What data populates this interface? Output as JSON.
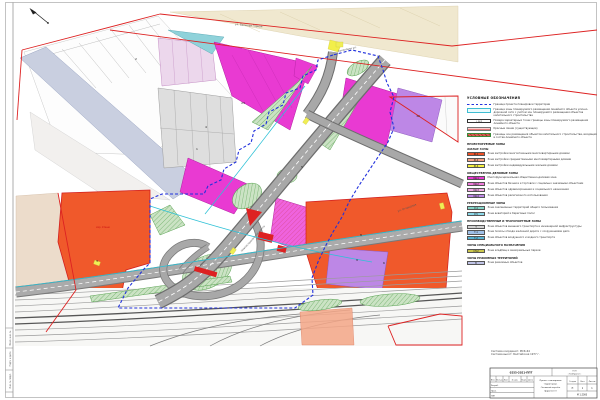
{
  "legend": {
    "title": "УСЛОВНЫЕ ОБОЗНАЧЕНИЯ",
    "symbols": [
      {
        "kind": "dash",
        "label": "Граница проекта планировки территории"
      },
      {
        "kind": "cyanbox",
        "label": "Граница зоны планируемого размещения линейного объекта улично-дорожной сети с учётом зон планируемого размещения объектов капитального строительства"
      },
      {
        "kind": "point",
        "code": "А-1",
        "label": "Номера характерных точек границы зоны планируемого размещения линейного объекта"
      },
      {
        "kind": "redline",
        "label": "Красные линии (существующие)"
      },
      {
        "kind": "redhatch",
        "label": "Границы зон размещения объектов капитального строительства, входящих в состав линейного объекта"
      }
    ],
    "groups": [
      {
        "header": "ПРОЕКТИРУЕМЫЕ ЗОНЫ",
        "subheader": "ЖИЛЫЕ ЗОНЫ",
        "items": [
          {
            "code": "Ж-1",
            "color": "#ee5026",
            "label": "Зона застройки многоэтажными многоквартирными домами"
          },
          {
            "code": "Ж-2",
            "color": "#f4a285",
            "label": "Зона застройки среднеэтажными многоквартирными домами"
          },
          {
            "code": "Ж-4",
            "color": "#f6f140",
            "label": "Зона застройки индивидуальными жилыми домами"
          }
        ]
      },
      {
        "header": "ОБЩЕСТВЕННО-ДЕЛОВЫЕ ЗОНЫ",
        "items": [
          {
            "code": "ОД-1",
            "color": "#e93ad2",
            "label": "Многофункциональная общественно-деловая зона"
          },
          {
            "code": "ОД-2",
            "color": "#f07bdb",
            "label": "Зона объектов бизнеса и торговли с социально значимыми объектами"
          },
          {
            "code": "ОД-3",
            "color": "#f3abe7",
            "label": "Зона объектов здравоохранения и социального назначения"
          },
          {
            "code": "ОД-4",
            "color": "#bd87e6",
            "label": "Зона объектов религиозного использования"
          }
        ]
      },
      {
        "header": "РЕКРЕАЦИОННЫЕ ЗОНЫ",
        "items": [
          {
            "code": "Р-4",
            "color": "#86d6c9",
            "label": "Зона озеленённых территорий общего пользования"
          },
          {
            "code": "Р-5",
            "color": "#8cd8e8",
            "label": "Зона акваторий и береговых полос"
          }
        ]
      },
      {
        "header": "ПРОИЗВОДСТВЕННЫЕ И ТРАНСПОРТНЫЕ ЗОНЫ",
        "items": [
          {
            "code": "Т",
            "color": "#d2d2d2",
            "label": "Зона объектов внешнего транспорта и инженерной инфраструктуры"
          },
          {
            "code": "Т-1",
            "color": "#9fc0e8",
            "label": "Зона полосы отвода железной дороги с сооружениями депо"
          },
          {
            "code": "Т-2",
            "color": "#58b4d4",
            "label": "Зона объектов воздушного и водного транспорта"
          }
        ]
      },
      {
        "header": "ЗОНЫ СПЕЦИАЛЬНОГО НАЗНАЧЕНИЯ",
        "items": [
          {
            "code": "СН-2",
            "color": "#cdc94e",
            "label": "Зона кладбищ и мемориальных парков"
          }
        ]
      },
      {
        "header": "ЗОНЫ РЕЖИМНЫХ ТЕРРИТОРИЙ",
        "items": [
          {
            "code": "В",
            "color": "#bfc3e6",
            "label": "Зона режимных объектов"
          }
        ]
      }
    ]
  },
  "map": {
    "street_labels": [
      {
        "text": "Соколовая ул.",
        "x": 338,
        "y": 52,
        "rot": -12
      },
      {
        "text": "ул. Большая Горная",
        "x": 235,
        "y": 25,
        "rot": 5
      },
      {
        "text": "Новоастраханское шоссе",
        "x": 242,
        "y": 252,
        "rot": -48
      },
      {
        "text": "ул. Огородная",
        "x": 398,
        "y": 212,
        "rot": -20
      }
    ],
    "zone_numbers": [
      {
        "text": "23",
        "x": 243,
        "y": 104
      },
      {
        "text": "1",
        "x": 197,
        "y": 150
      },
      {
        "text": "2",
        "x": 136,
        "y": 60
      },
      {
        "text": "4",
        "x": 206,
        "y": 128
      },
      {
        "text": "5",
        "x": 302,
        "y": 168
      },
      {
        "text": "8",
        "x": 361,
        "y": 236
      },
      {
        "text": "9",
        "x": 357,
        "y": 261
      },
      {
        "text": "12",
        "x": 418,
        "y": 117
      },
      {
        "text": "6",
        "x": 384,
        "y": 264
      },
      {
        "text": "3",
        "x": 97,
        "y": 262
      }
    ],
    "red_note": "мкр. Улеши"
  },
  "notes": [
    "Система координат: МСК-64",
    "Система высот: Балтийская 1977 г."
  ],
  "margin_labels": [
    "Взам. инв. №",
    "Подп. и дата",
    "Инв. № подл."
  ],
  "stamp": {
    "doc_number": "0255-2021-ППТ",
    "org_lines": [
      "ООО",
      "«ГеоПроект»"
    ],
    "title_lines": [
      "Проект планировки",
      "территории.",
      "Основной чертёж",
      "(фрагмент)"
    ],
    "columns": [
      "Изм.",
      "Кол.уч",
      "Лист",
      "№ док.",
      "Подп.",
      "Дата"
    ],
    "roles": [
      "Разраб.",
      "Пров.",
      "ГИП"
    ],
    "stage_label": "Стадия",
    "sheet_label": "Лист",
    "sheets_label": "Листов",
    "stage": "П",
    "sheet": "1",
    "sheets": "1",
    "scale": "М 1:2000"
  }
}
